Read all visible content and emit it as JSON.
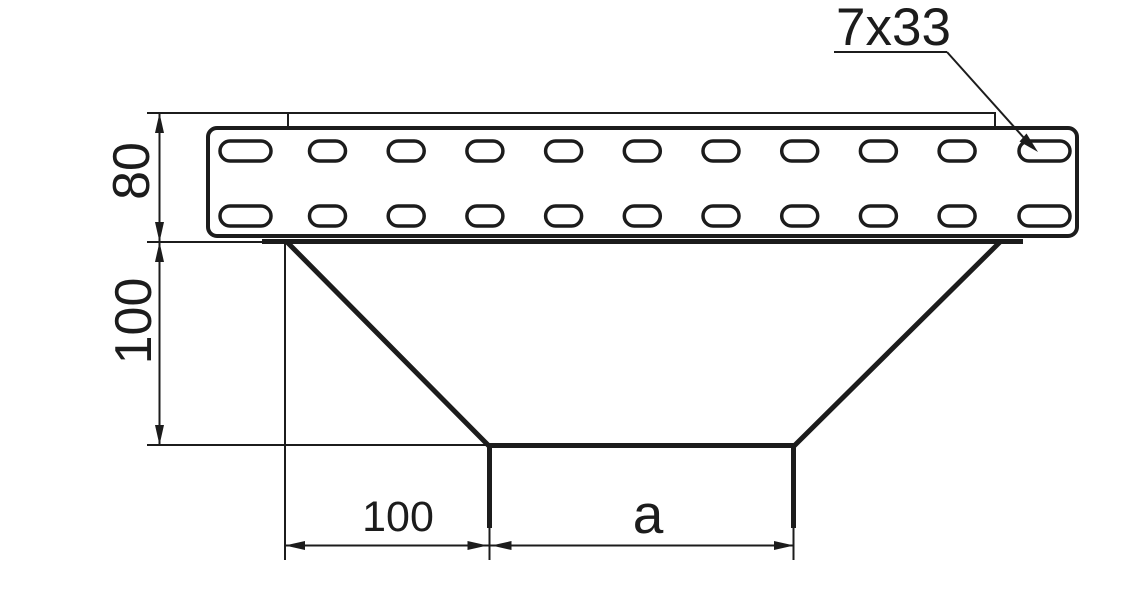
{
  "drawing": {
    "background": "#ffffff",
    "line_color": "#1c1c1c",
    "dimensions": {
      "rail_height": "80",
      "funnel_drop": "100",
      "bottom_left_offset": "100",
      "bottom_opening_width": "a"
    },
    "callout": {
      "slot_spec": "7x33"
    },
    "perforation": {
      "rows": 2,
      "slots_per_row": 11
    }
  }
}
